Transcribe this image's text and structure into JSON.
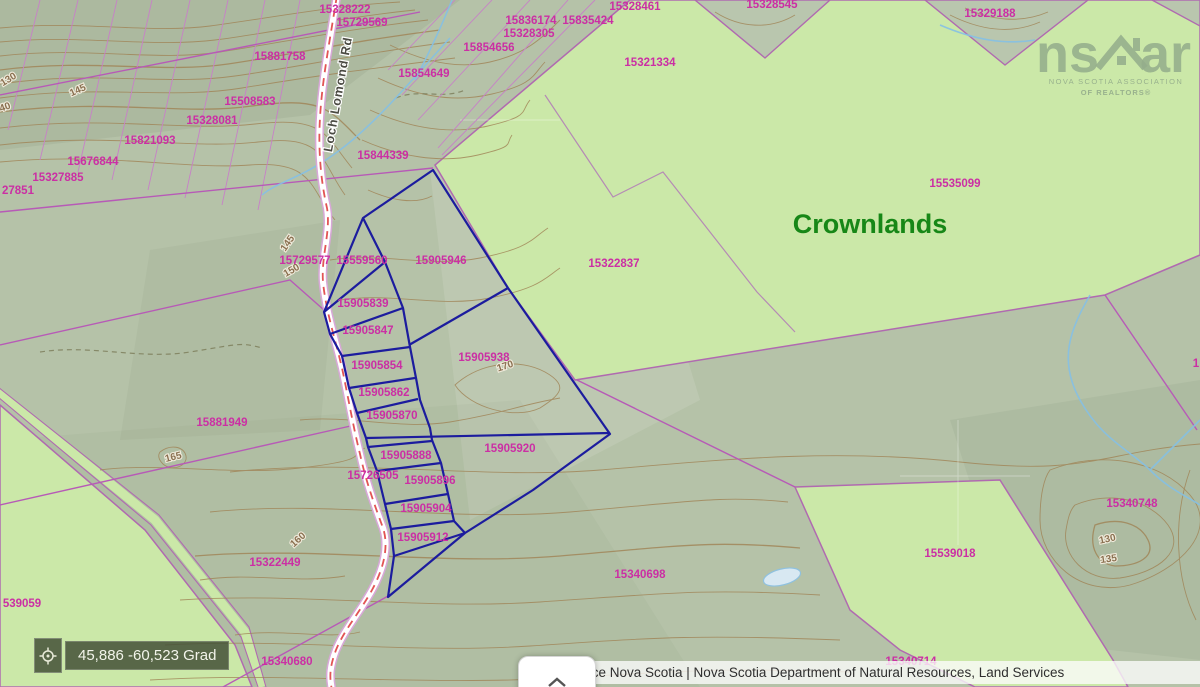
{
  "parcels": {
    "p15328222": "15328222",
    "p15729569": "15729569",
    "p15881758": "15881758",
    "p15854649": "15854649",
    "p15854656": "15854656",
    "p15328305": "15328305",
    "p15836174": "15836174",
    "p15835424": "15835424",
    "p15328461": "15328461",
    "p15328545": "15328545",
    "p15329188": "15329188",
    "p15321334": "15321334",
    "p15508583": "15508583",
    "p15328081": "15328081",
    "p15821093": "15821093",
    "p15676844": "15676844",
    "p15327885": "15327885",
    "p27851": "27851",
    "p15844339": "15844339",
    "p15535099": "15535099",
    "p15322837": "15322837",
    "p15729577": "15729577",
    "p15559560": "15559560",
    "p15905946": "15905946",
    "p15905839": "15905839",
    "p15905847": "15905847",
    "p15905854": "15905854",
    "p15905862": "15905862",
    "p15905870": "15905870",
    "p15905938": "15905938",
    "p15905920": "15905920",
    "p15905888": "15905888",
    "p15726505": "15726505",
    "p15905896": "15905896",
    "p15905904": "15905904",
    "p15905912": "15905912",
    "p15881949": "15881949",
    "p15322449": "15322449",
    "p539059": "539059",
    "p15340698": "15340698",
    "p15539018": "15539018",
    "p15340748": "15340748",
    "p15340714": "15340714",
    "p15340680": "15340680",
    "p_edge_right": "1"
  },
  "contours": {
    "c130a": "130",
    "c145a": "145",
    "c140a": "40",
    "c145b": "145",
    "c150": "150",
    "c165": "165",
    "c160": "160",
    "c170": "170",
    "c130b": "130",
    "c135": "135"
  },
  "labels": {
    "crownlands": "Crownlands",
    "road": "Loch Lomond Rd"
  },
  "logo": {
    "ns": "ns",
    "ar": "ar",
    "line1": "NOVA SCOTIA ASSOCIATION",
    "line2": "OF REALTORS®"
  },
  "coordinates": {
    "value": "45,886 -60,523 Grad"
  },
  "attribution": {
    "text": "Service Nova Scotia | Nova Scotia Department of Natural Resources, Land Services"
  },
  "colors": {
    "crownland_fill": "#cbe8a8",
    "terrain_fill": "#b5c2a8",
    "parcel_line": "#b75ab7",
    "parcel_text": "#cb2fa4",
    "highlight_boundary": "#1c1c9e",
    "crownlands_text": "#178717",
    "contour_line": "#a08355",
    "road_centerline": "#e25454",
    "stream": "#85c0e4",
    "readout_bg": "#48543a"
  }
}
